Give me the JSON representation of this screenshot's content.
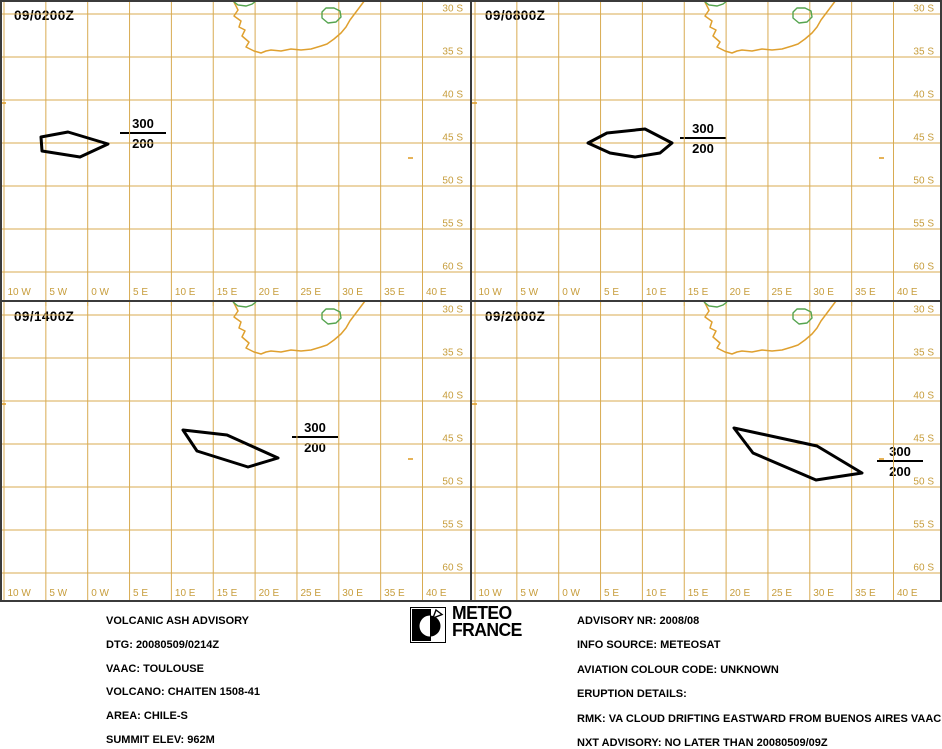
{
  "colors": {
    "grid": "#d8ab52",
    "label": "#c79d3c",
    "coast": "#dfa02f",
    "border_green": "#55a44f",
    "ash": "#000000",
    "frame": "#3b3b3b",
    "text": "#000000"
  },
  "map": {
    "panel_w": 471,
    "panel_h": 301,
    "grid_x0": 4,
    "grid_dx": 41.85,
    "grid_y0": 14,
    "grid_dy": 43,
    "lon_labels": [
      "10 W",
      "5 W",
      "0 W",
      "5 E",
      "10 E",
      "15 E",
      "20 E",
      "25 E",
      "30 E",
      "35 E",
      "40 E"
    ],
    "lat_labels": [
      "30 S",
      "35 S",
      "40 S",
      "45 S",
      "50 S",
      "55 S",
      "60 S"
    ],
    "coastline": [
      [
        233,
        0
      ],
      [
        236,
        6
      ],
      [
        238,
        10
      ],
      [
        234,
        16
      ],
      [
        241,
        21
      ],
      [
        239,
        27
      ],
      [
        245,
        30
      ],
      [
        242,
        36
      ],
      [
        249,
        42
      ],
      [
        246,
        47
      ],
      [
        254,
        51
      ],
      [
        261,
        53
      ],
      [
        266,
        51
      ],
      [
        271,
        50
      ],
      [
        281,
        51
      ],
      [
        291,
        49
      ],
      [
        301,
        50
      ],
      [
        311,
        49
      ],
      [
        321,
        46
      ],
      [
        327,
        44
      ],
      [
        334,
        39
      ],
      [
        341,
        33
      ],
      [
        346,
        27
      ],
      [
        350,
        20
      ],
      [
        356,
        12
      ],
      [
        362,
        4
      ],
      [
        365,
        0
      ]
    ],
    "lesotho_border": [
      [
        322,
        12
      ],
      [
        326,
        8
      ],
      [
        334,
        8
      ],
      [
        340,
        11
      ],
      [
        341,
        17
      ],
      [
        336,
        22
      ],
      [
        328,
        23
      ],
      [
        322,
        18
      ]
    ],
    "north_border": [
      [
        233,
        1
      ],
      [
        238,
        5
      ],
      [
        246,
        6
      ],
      [
        252,
        4
      ],
      [
        256,
        1
      ]
    ],
    "islands": [
      [
        408,
        158
      ],
      [
        1,
        103
      ]
    ]
  },
  "panels": [
    {
      "title": "09/0200Z",
      "polygon": [
        [
          41,
          137
        ],
        [
          68,
          132
        ],
        [
          108,
          144
        ],
        [
          80,
          157
        ],
        [
          42,
          151
        ]
      ],
      "label": {
        "top": "300",
        "bottom": "200",
        "x": 143,
        "y": 134
      }
    },
    {
      "title": "09/0800Z",
      "polygon": [
        [
          117,
          143
        ],
        [
          136,
          133
        ],
        [
          174,
          129
        ],
        [
          201,
          143
        ],
        [
          189,
          153
        ],
        [
          164,
          157
        ],
        [
          139,
          153
        ]
      ],
      "label": {
        "top": "300",
        "bottom": "200",
        "x": 232,
        "y": 139
      }
    },
    {
      "title": "09/1400Z",
      "polygon": [
        [
          183,
          129
        ],
        [
          227,
          134
        ],
        [
          278,
          157
        ],
        [
          248,
          166
        ],
        [
          197,
          150
        ]
      ],
      "label": {
        "top": "300",
        "bottom": "200",
        "x": 315,
        "y": 137
      }
    },
    {
      "title": "09/2000Z",
      "polygon": [
        [
          263,
          127
        ],
        [
          346,
          145
        ],
        [
          391,
          172
        ],
        [
          345,
          179
        ],
        [
          282,
          152
        ]
      ],
      "label": {
        "top": "300",
        "bottom": "200",
        "x": 429,
        "y": 161
      }
    }
  ],
  "footer": {
    "left_lines": [
      "VOLCANIC ASH ADVISORY",
      "DTG: 20080509/0214Z",
      "VAAC: TOULOUSE",
      "VOLCANO: CHAITEN 1508-41",
      "AREA: CHILE-S",
      "SUMMIT ELEV: 962M"
    ],
    "right_lines": [
      "ADVISORY NR: 2008/08",
      "INFO SOURCE: METEOSAT",
      "AVIATION COLOUR CODE: UNKNOWN",
      "ERUPTION DETAILS:",
      "RMK: VA CLOUD DRIFTING EASTWARD FROM BUENOS AIRES VAAC",
      "NXT ADVISORY: NO LATER THAN 20080509/09Z"
    ],
    "logo": {
      "line1": "METEO",
      "line2": "FRANCE"
    }
  }
}
